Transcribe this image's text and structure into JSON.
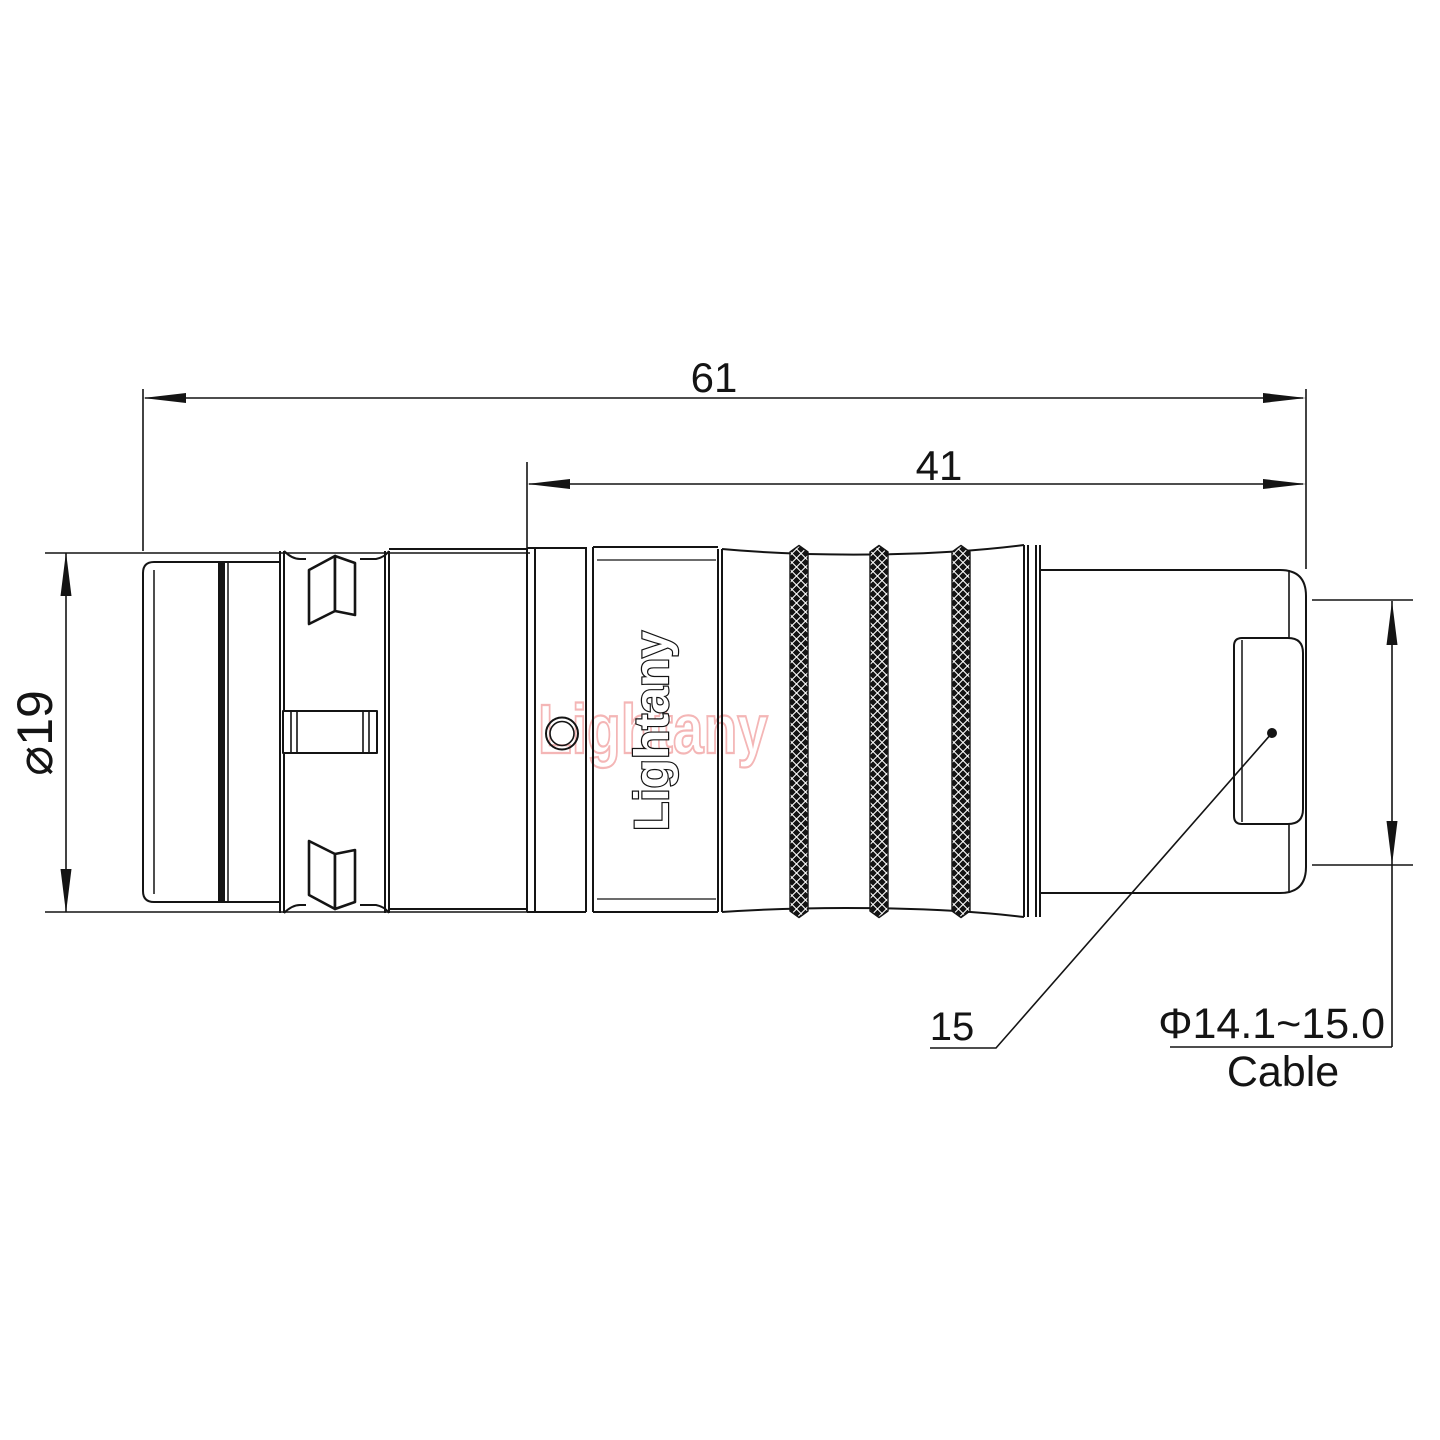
{
  "drawing": {
    "type": "connector-dimension-drawing",
    "dim_overall_length": "61",
    "dim_rear_length": "41",
    "dim_body_diameter": "⌀19",
    "dim_boot_callout": "15",
    "dim_cable_range": "Φ14.1~15.0",
    "dim_cable_label": "Cable",
    "brand_engraving": "Lightany",
    "watermark": "Lightany",
    "colors": {
      "line": "#141414",
      "background": "#ffffff",
      "watermark_pink": "#f4b6b6"
    }
  }
}
